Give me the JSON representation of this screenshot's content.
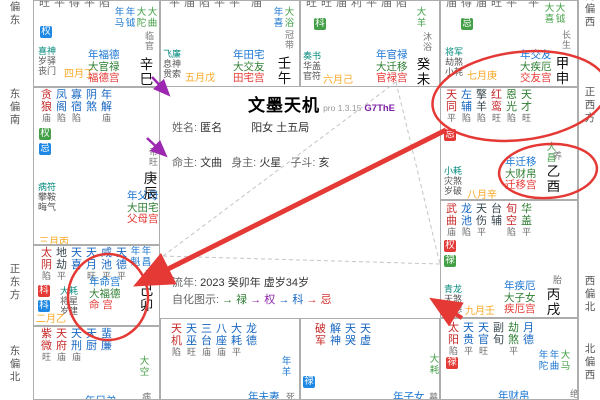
{
  "app": {
    "title": "文墨天机",
    "version": "pro 1.3.15",
    "code": "G7ThE"
  },
  "center": {
    "name_label": "姓名:",
    "name": "匿名",
    "gender": "阳女",
    "bureau": "土五局",
    "ming_lord_label": "命主:",
    "ming_lord": "文曲",
    "body_lord_label": "身主:",
    "body_lord": "火星",
    "dou_label": "子斗:",
    "dou": "亥",
    "liunian_label": "流年:",
    "liunian_value": "2023 癸卯年",
    "age": "虚岁34岁",
    "zihua_label": "自化图示:",
    "zihua_items": [
      {
        "text": "→ 禄",
        "color": "#2e7d32"
      },
      {
        "text": "→ 权",
        "color": "#8e24aa"
      },
      {
        "text": "→ 科",
        "color": "#1565c0"
      },
      {
        "text": "→ 忌",
        "color": "#d32f2f"
      }
    ]
  },
  "compass": {
    "left": [
      "南偏东",
      "东偏南",
      "正东方",
      "东偏北"
    ],
    "right": [
      "南偏西",
      "正西方",
      "西偏北",
      "北偏西"
    ]
  },
  "colors": {
    "accent_red": "#e53935",
    "arrow_purple": "#9c27b0",
    "dashed_gray": "#c4c4c4"
  },
  "palaces": [
    {
      "id": "si",
      "ganzhi": "辛巳",
      "stage": "临官",
      "top_brightness": "旺平得平陷",
      "stars": [],
      "badges": [
        {
          "t": "权",
          "bg": "blue"
        }
      ],
      "minors": [
        "喜神",
        "岁驿",
        "丧门"
      ],
      "month": "四月丁",
      "flow_stars": [
        [
          "年马",
          "b"
        ],
        [
          "年钺",
          "b"
        ],
        [
          "大陀",
          "g"
        ],
        [
          "大曲",
          "g"
        ]
      ],
      "labels": [
        "年福德",
        "大官禄",
        "福德宫"
      ]
    },
    {
      "id": "wu",
      "ganzhi": "壬午",
      "stage": "冠带",
      "top_brightness": "平庙陷平平 庙",
      "stars": [],
      "badges": [],
      "minors": [
        "飞廉",
        "息神",
        "贯索"
      ],
      "month": "五月戊",
      "flow_stars": [
        [
          "年喜",
          "b"
        ],
        [
          "大浴",
          "g"
        ]
      ],
      "labels": [
        "年田宅",
        "大交友",
        "田宅宫"
      ]
    },
    {
      "id": "wei",
      "ganzhi": "癸未",
      "stage": "沐浴",
      "top_brightness": "旺旺庙利平庙陷",
      "stars": [],
      "badges": [
        {
          "t": "科",
          "bg": "green"
        }
      ],
      "minors": [
        "奏书",
        "华盖",
        "官符"
      ],
      "month": "六月己",
      "flow_stars": [
        [
          "大羊",
          "g"
        ]
      ],
      "labels": [
        "年官禄",
        "大迁移",
        "官禄宫"
      ]
    },
    {
      "id": "shen",
      "ganzhi": "甲申",
      "stage": "长生",
      "top_brightness": "庙得庙旺平 平",
      "stars": [],
      "badges": [
        {
          "t": "忌",
          "bg": "green"
        }
      ],
      "minors": [
        "将军",
        "劫煞",
        "小耗"
      ],
      "month": "七月庚",
      "flow_stars": [
        [
          "大喜",
          "g"
        ],
        [
          "大钺",
          "g"
        ]
      ],
      "labels": [
        "年交友",
        "大疾厄",
        "交友宫"
      ]
    },
    {
      "id": "you",
      "ganzhi": "乙酉",
      "stage": "养",
      "stars": [
        [
          "天同",
          "r",
          "平"
        ],
        [
          "左辅",
          "b",
          "陷"
        ],
        [
          "擎羊",
          "k",
          "陷"
        ],
        [
          "红鸾",
          "r",
          "旺"
        ],
        [
          "恩光",
          "g",
          "陷"
        ],
        [
          "天才",
          "g",
          "旺"
        ]
      ],
      "badges": [
        {
          "t": "忌",
          "bg": "red"
        }
      ],
      "minors": [
        "小耗",
        "灾煞",
        "岁破"
      ],
      "month": "八月辛",
      "flow_stars": [
        [
          "大昌",
          "g"
        ]
      ],
      "labels": [
        "年迁移",
        "大财帛",
        "迁移宫"
      ]
    },
    {
      "id": "xu",
      "ganzhi": "丙戌",
      "stage": "胎",
      "stars": [
        [
          "武曲",
          "r",
          "庙"
        ],
        [
          "龙池",
          "b",
          "陷"
        ],
        [
          "天伤",
          "k",
          "平"
        ],
        [
          "台辅",
          "k",
          ""
        ],
        [
          "旬空",
          "r",
          "陷"
        ],
        [
          "华盖",
          "g",
          "平"
        ]
      ],
      "badges": [
        {
          "t": "权",
          "bg": "red"
        },
        {
          "t": "禄",
          "bg": "green"
        }
      ],
      "minors": [
        "青龙",
        "天煞",
        "龙德"
      ],
      "month": "九月壬",
      "flow_stars": [],
      "labels": [
        "年疾厄",
        "大子女",
        "疾厄宫"
      ]
    },
    {
      "id": "hai",
      "ganzhi": "",
      "stage": "绝",
      "stars": [
        [
          "太阳",
          "r",
          "陷"
        ],
        [
          "天贵",
          "b",
          "平"
        ],
        [
          "天官",
          "b",
          "旺"
        ],
        [
          "副旬",
          "k",
          ""
        ],
        [
          "劫煞",
          "g",
          "平"
        ],
        [
          "月德",
          "b",
          ""
        ]
      ],
      "badges": [
        {
          "t": "禄",
          "bg": "red"
        }
      ],
      "minors": [],
      "month": "",
      "flow_stars": [
        [
          "年陀",
          "b"
        ],
        [
          "年曲",
          "b"
        ],
        [
          "大马",
          "g"
        ]
      ],
      "labels": [
        "年财帛"
      ],
      "cut": true
    },
    {
      "id": "chen",
      "ganzhi": "庚辰",
      "stage": "帝旺",
      "stars": [
        [
          "贪狼",
          "r",
          "庙"
        ],
        [
          "凤阁",
          "b",
          "陷"
        ],
        [
          "寡宿",
          "b",
          "陷"
        ],
        [
          "阴煞",
          "b",
          ""
        ],
        [
          "年解",
          "b",
          "庙"
        ]
      ],
      "badges": [
        {
          "t": "权",
          "bg": "green"
        },
        {
          "t": "忌",
          "bg": "blue"
        }
      ],
      "minors": [
        "病符",
        "攀鞍",
        "晦气"
      ],
      "month": "三月丙",
      "flow_stars": [],
      "labels": [
        "年父母",
        "大田宅",
        "父母宫"
      ]
    },
    {
      "id": "mao",
      "ganzhi": "己卯",
      "stage": "衰",
      "stars": [
        [
          "太阴",
          "r",
          "陷"
        ],
        [
          "地劫",
          "k",
          "平"
        ],
        [
          "天喜",
          "b",
          ""
        ],
        [
          "天月",
          "b",
          "旺"
        ],
        [
          "咸池",
          "b",
          "平"
        ],
        [
          "天德",
          "b",
          "平"
        ]
      ],
      "badges": [
        {
          "t": "科",
          "bg": "red"
        },
        {
          "t": "科",
          "bg": "blue"
        }
      ],
      "minors": [
        "大耗",
        "将星",
        "岁建"
      ],
      "month": "二月乙",
      "flow_stars": [
        [
          "年魁",
          "b"
        ],
        [
          "年昌",
          "b"
        ]
      ],
      "labels": [
        "年命宫",
        "大福德",
        "命 宫"
      ]
    },
    {
      "id": "yin",
      "ganzhi": "",
      "stage": "病",
      "stars": [
        [
          "紫微",
          "r",
          "旺"
        ],
        [
          "天府",
          "r",
          "庙"
        ],
        [
          "天刑",
          "b",
          "庙"
        ],
        [
          "天厨",
          "b",
          ""
        ],
        [
          "蜚廉",
          "b",
          ""
        ]
      ],
      "badges": [],
      "minors": [],
      "month": "",
      "flow_stars": [
        [
          "大空",
          "g"
        ]
      ],
      "labels": [
        "年兄弟"
      ],
      "cut": true
    },
    {
      "id": "chou",
      "ganzhi": "",
      "stage": "死",
      "stars": [
        [
          "天机",
          "r",
          "陷"
        ],
        [
          "天巫",
          "b",
          "旺"
        ],
        [
          "三台",
          "b",
          "庙"
        ],
        [
          "八座",
          "b",
          "庙"
        ],
        [
          "大耗",
          "b",
          "平"
        ],
        [
          "龙德",
          "b",
          ""
        ]
      ],
      "badges": [],
      "minors": [],
      "month": "",
      "flow_stars": [
        [
          "年羊",
          "b"
        ]
      ],
      "labels": [
        "年夫妻"
      ],
      "cut": true
    },
    {
      "id": "zi",
      "ganzhi": "",
      "stage": "墓",
      "stars": [
        [
          "破军",
          "r",
          ""
        ],
        [
          "解神",
          "b",
          ""
        ],
        [
          "天哭",
          "b",
          ""
        ],
        [
          "天虚",
          "b",
          ""
        ]
      ],
      "badges": [
        {
          "t": "禄",
          "bg": "blue"
        }
      ],
      "minors": [],
      "month": "",
      "flow_stars": [
        [
          "大耗",
          "g"
        ]
      ],
      "labels": [
        "年子女"
      ],
      "cut": true
    }
  ]
}
